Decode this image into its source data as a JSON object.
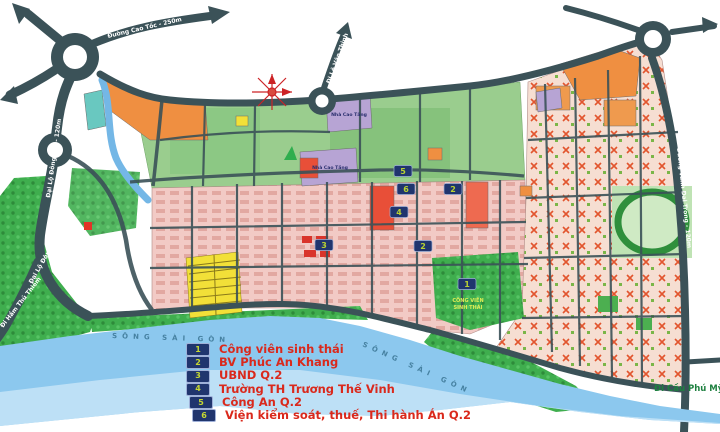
{
  "legend": {
    "items": [
      {
        "num": "1",
        "label": "Công viên sinh thái"
      },
      {
        "num": "2",
        "label": "BV Phúc An Khang"
      },
      {
        "num": "3",
        "label": "UBND Q.2"
      },
      {
        "num": "4",
        "label": "Trường TH Trương Thế Vinh"
      },
      {
        "num": "5",
        "label": "Công An Q.2"
      },
      {
        "num": "6",
        "label": "Viện kiểm soát, thuế, Thi hành Án Q.2"
      }
    ]
  },
  "roads": {
    "cao_toc": "Đường Cao Tốc - 250m",
    "dong_tay_upper": "Đại Lộ Đông Tây - 120m",
    "dong_tay_lower": "Đại Lộ Đông Tây - 120m",
    "ham_thu_thiem": "Đi Hầm Thủ Thiêm",
    "le_van_thinh": "Đi Lê Văn Thịnh",
    "vanh_dai_trong": "Đường Vành Đai Trong - 120m",
    "cau_phu_my": "Đi Cầu Phú Mỹ - Q.7"
  },
  "areas": {
    "nha_cao_tang_upper": "Nhà Cao Tầng",
    "nha_cao_tang_lower": "Nhà Cao Tầng",
    "song_sai_gon_west": "SÔNG SÀI GÒN",
    "song_sai_gon_east": "SÔNG SÀI GÒN",
    "cong_vien_line1": "CÔNG VIÊN",
    "cong_vien_line2": "SINH THÁI"
  },
  "markers": [
    {
      "num": "5"
    },
    {
      "num": "6"
    },
    {
      "num": "2"
    },
    {
      "num": "4"
    },
    {
      "num": "2"
    },
    {
      "num": "3"
    },
    {
      "num": "1"
    }
  ],
  "colors": {
    "road": "#3b5258",
    "river": "#8cc8ee",
    "park_green": "#3fae4e",
    "block_pink": "#f1c9c4",
    "orange_parcel": "#ef8f41",
    "lavender_parcel": "#b7a4d4",
    "yellow_parcel": "#f2e038",
    "legend_navy": "#20356e",
    "legend_number": "#c6d832",
    "legend_text": "#da291c",
    "label_green": "#1e8040",
    "star_red": "#cc2326"
  }
}
